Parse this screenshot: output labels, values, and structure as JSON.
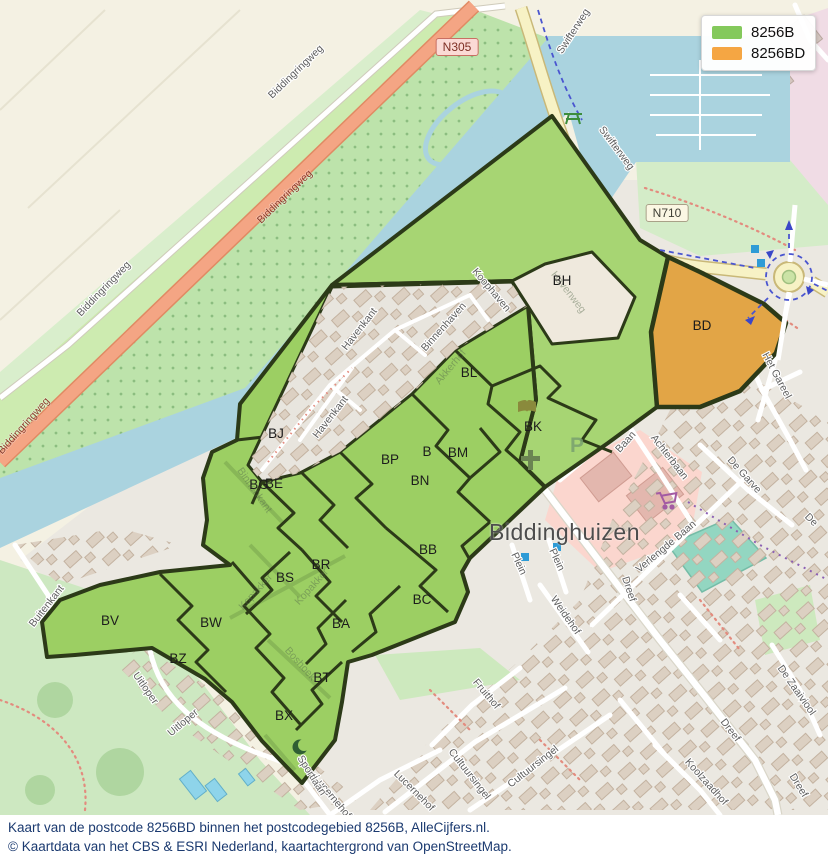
{
  "legend": {
    "items": [
      {
        "label": "8256B",
        "color": "#84C95B"
      },
      {
        "label": "8256BD",
        "color": "#F5A643"
      }
    ]
  },
  "road_badges": [
    {
      "text": "N305"
    },
    {
      "text": "N710"
    }
  ],
  "town_label": "Biddinghuizen",
  "colors": {
    "green_area": "#9CCF63",
    "green_area_light": "#A7D573",
    "orange_area": "#E2A546",
    "outline": "#2C3A18",
    "water": "#AAD3DF",
    "road_primary": "#F4A584",
    "road_secondary": "#F7F2C5"
  },
  "icons": {
    "parking_letter": "P"
  },
  "area_labels": [
    {
      "code": "BH",
      "x": 562,
      "y": 285
    },
    {
      "code": "BD",
      "x": 702,
      "y": 330
    },
    {
      "code": "BL",
      "x": 469,
      "y": 377
    },
    {
      "code": "BK",
      "x": 533,
      "y": 431
    },
    {
      "code": "BJ",
      "x": 276,
      "y": 438
    },
    {
      "code": "BG",
      "x": 259,
      "y": 489
    },
    {
      "code": "BE",
      "x": 274,
      "y": 488
    },
    {
      "code": "BP",
      "x": 390,
      "y": 464
    },
    {
      "code": "B",
      "x": 427,
      "y": 456
    },
    {
      "code": "BM",
      "x": 458,
      "y": 457
    },
    {
      "code": "BN",
      "x": 420,
      "y": 485
    },
    {
      "code": "BB",
      "x": 428,
      "y": 554
    },
    {
      "code": "BR",
      "x": 321,
      "y": 569
    },
    {
      "code": "BS",
      "x": 285,
      "y": 582
    },
    {
      "code": "BC",
      "x": 422,
      "y": 604
    },
    {
      "code": "BA",
      "x": 341,
      "y": 628
    },
    {
      "code": "BW",
      "x": 211,
      "y": 627
    },
    {
      "code": "BV",
      "x": 110,
      "y": 625
    },
    {
      "code": "BZ",
      "x": 178,
      "y": 663
    },
    {
      "code": "BT",
      "x": 322,
      "y": 682
    },
    {
      "code": "BX",
      "x": 284,
      "y": 720
    }
  ],
  "street_labels": [
    {
      "name": "Swifterweg",
      "x": 576,
      "y": 33,
      "rot": -57,
      "style": ""
    },
    {
      "name": "Swifterweg",
      "x": 614,
      "y": 150,
      "rot": 53,
      "style": ""
    },
    {
      "name": "Biddingringweg",
      "x": 298,
      "y": 74,
      "rot": -44,
      "style": ""
    },
    {
      "name": "Biddingringweg",
      "x": 106,
      "y": 291,
      "rot": -46,
      "style": ""
    },
    {
      "name": "Biddingringweg",
      "x": 287,
      "y": 199,
      "rot": -44,
      "style": "red"
    },
    {
      "name": "Biddingringweg",
      "x": 26,
      "y": 428,
      "rot": -48,
      "style": "red"
    },
    {
      "name": "Havenkant",
      "x": 362,
      "y": 331,
      "rot": -52,
      "style": ""
    },
    {
      "name": "Havenkant",
      "x": 333,
      "y": 419,
      "rot": -52,
      "style": ""
    },
    {
      "name": "Binnenhaven",
      "x": 446,
      "y": 329,
      "rot": -48,
      "style": ""
    },
    {
      "name": "Koophaven",
      "x": 489,
      "y": 292,
      "rot": 50,
      "style": ""
    },
    {
      "name": "Akkerhof",
      "x": 453,
      "y": 369,
      "rot": -50,
      "style": "faint"
    },
    {
      "name": "Havenweg",
      "x": 566,
      "y": 294,
      "rot": 52,
      "style": "faint"
    },
    {
      "name": "Binnenkant",
      "x": 252,
      "y": 492,
      "rot": 55,
      "style": "faint"
    },
    {
      "name": "Kopakker",
      "x": 258,
      "y": 594,
      "rot": -48,
      "style": "faint"
    },
    {
      "name": "Kopakker",
      "x": 314,
      "y": 589,
      "rot": -48,
      "style": "faint"
    },
    {
      "name": "Boshoek",
      "x": 298,
      "y": 666,
      "rot": 48,
      "style": "faint"
    },
    {
      "name": "Baan",
      "x": 628,
      "y": 444,
      "rot": -48,
      "style": ""
    },
    {
      "name": "Achterbaan",
      "x": 667,
      "y": 459,
      "rot": 52,
      "style": ""
    },
    {
      "name": "Verlengde Baan",
      "x": 668,
      "y": 549,
      "rot": -40,
      "style": ""
    },
    {
      "name": "Dreef",
      "x": 626,
      "y": 590,
      "rot": 72,
      "style": ""
    },
    {
      "name": "Dreef",
      "x": 728,
      "y": 732,
      "rot": 52,
      "style": ""
    },
    {
      "name": "Dreef",
      "x": 796,
      "y": 787,
      "rot": 58,
      "style": ""
    },
    {
      "name": "Plein",
      "x": 516,
      "y": 565,
      "rot": 65,
      "style": ""
    },
    {
      "name": "Plein",
      "x": 554,
      "y": 561,
      "rot": 65,
      "style": ""
    },
    {
      "name": "Weidehof",
      "x": 563,
      "y": 617,
      "rot": 55,
      "style": ""
    },
    {
      "name": "Het Gareel",
      "x": 774,
      "y": 377,
      "rot": 62,
      "style": ""
    },
    {
      "name": "De Garve",
      "x": 742,
      "y": 477,
      "rot": 48,
      "style": ""
    },
    {
      "name": "De",
      "x": 809,
      "y": 522,
      "rot": 45,
      "style": ""
    },
    {
      "name": "De Zaaiviool",
      "x": 794,
      "y": 692,
      "rot": 55,
      "style": ""
    },
    {
      "name": "Koolzaadhof",
      "x": 704,
      "y": 784,
      "rot": 48,
      "style": ""
    },
    {
      "name": "Cultuursingel",
      "x": 467,
      "y": 776,
      "rot": 52,
      "style": ""
    },
    {
      "name": "Cultuursingel",
      "x": 535,
      "y": 769,
      "rot": -38,
      "style": ""
    },
    {
      "name": "Fruithof",
      "x": 484,
      "y": 696,
      "rot": 50,
      "style": ""
    },
    {
      "name": "Lucernehof",
      "x": 330,
      "y": 799,
      "rot": 50,
      "style": ""
    },
    {
      "name": "Lucernehof",
      "x": 412,
      "y": 793,
      "rot": 45,
      "style": ""
    },
    {
      "name": "Sportlaan",
      "x": 309,
      "y": 777,
      "rot": 58,
      "style": ""
    },
    {
      "name": "Uitloper",
      "x": 143,
      "y": 690,
      "rot": 55,
      "style": ""
    },
    {
      "name": "Uitloper",
      "x": 185,
      "y": 725,
      "rot": -40,
      "style": ""
    },
    {
      "name": "Buitenkant",
      "x": 49,
      "y": 608,
      "rot": -52,
      "style": ""
    }
  ],
  "caption": {
    "line1": "Kaart van de postcode 8256BD binnen het postcodegebied 8256B, AlleCijfers.nl.",
    "line2": "© Kaartdata van het CBS & ESRI Nederland, kaartachtergrond van OpenStreetMap."
  }
}
